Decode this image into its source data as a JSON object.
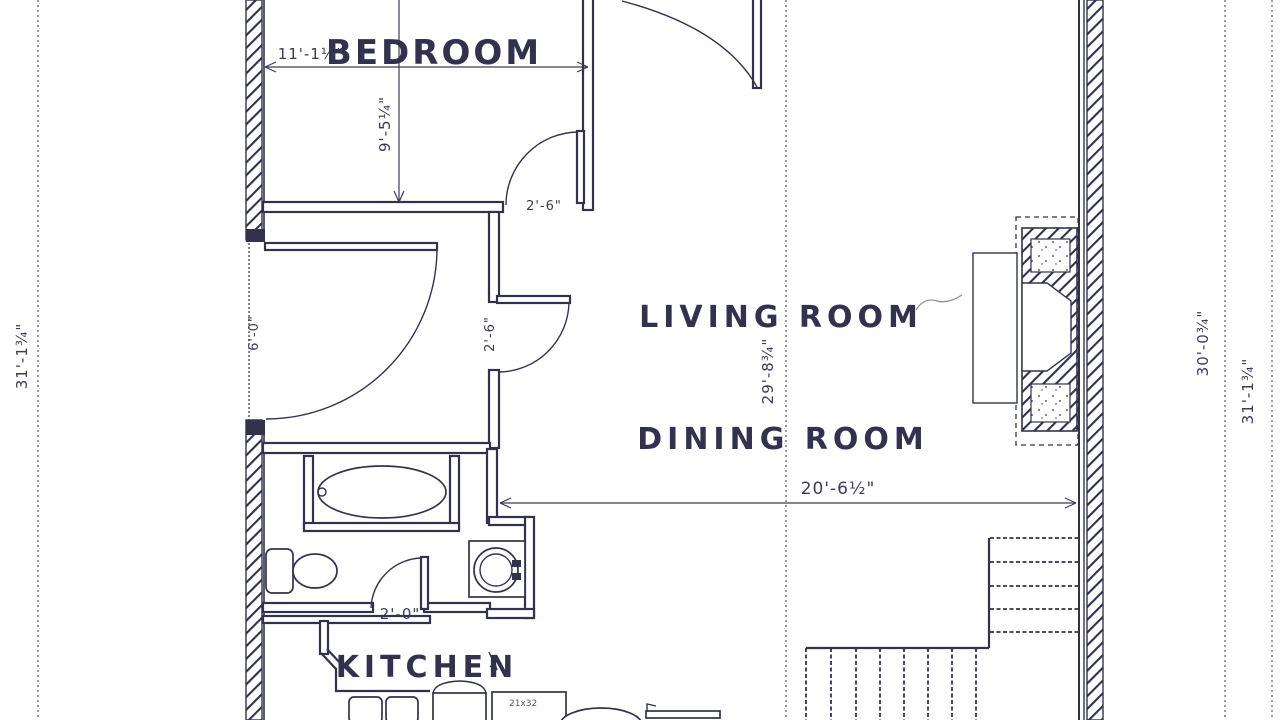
{
  "drawing": {
    "rooms": {
      "bedroom": "BEDROOM",
      "living_room": "LIVING ROOM",
      "dining_room": "DINING ROOM",
      "kitchen": "KITCHEN"
    },
    "dimensions": {
      "bedroom_width": "11'-1½\"",
      "bedroom_depth": "9'-5¼\"",
      "bedroom_door_width": "2'-6\"",
      "left_door_width": "6'-0\"",
      "hall_door_width": "2'-6\"",
      "bath_door_width": "2'-0\"",
      "living_dining_depth": "29'-8¾\"",
      "living_width": "20'-6½\"",
      "overall_height_left": "31'-1¾\"",
      "overall_height_right_inner": "30'-0¾\"",
      "overall_height_right_outer": "31'-1¾\"",
      "appliance_size": "21x32"
    },
    "colors": {
      "ink": "#32324e",
      "dim_ink": "#3c3c58",
      "paper": "#ffffff"
    }
  }
}
